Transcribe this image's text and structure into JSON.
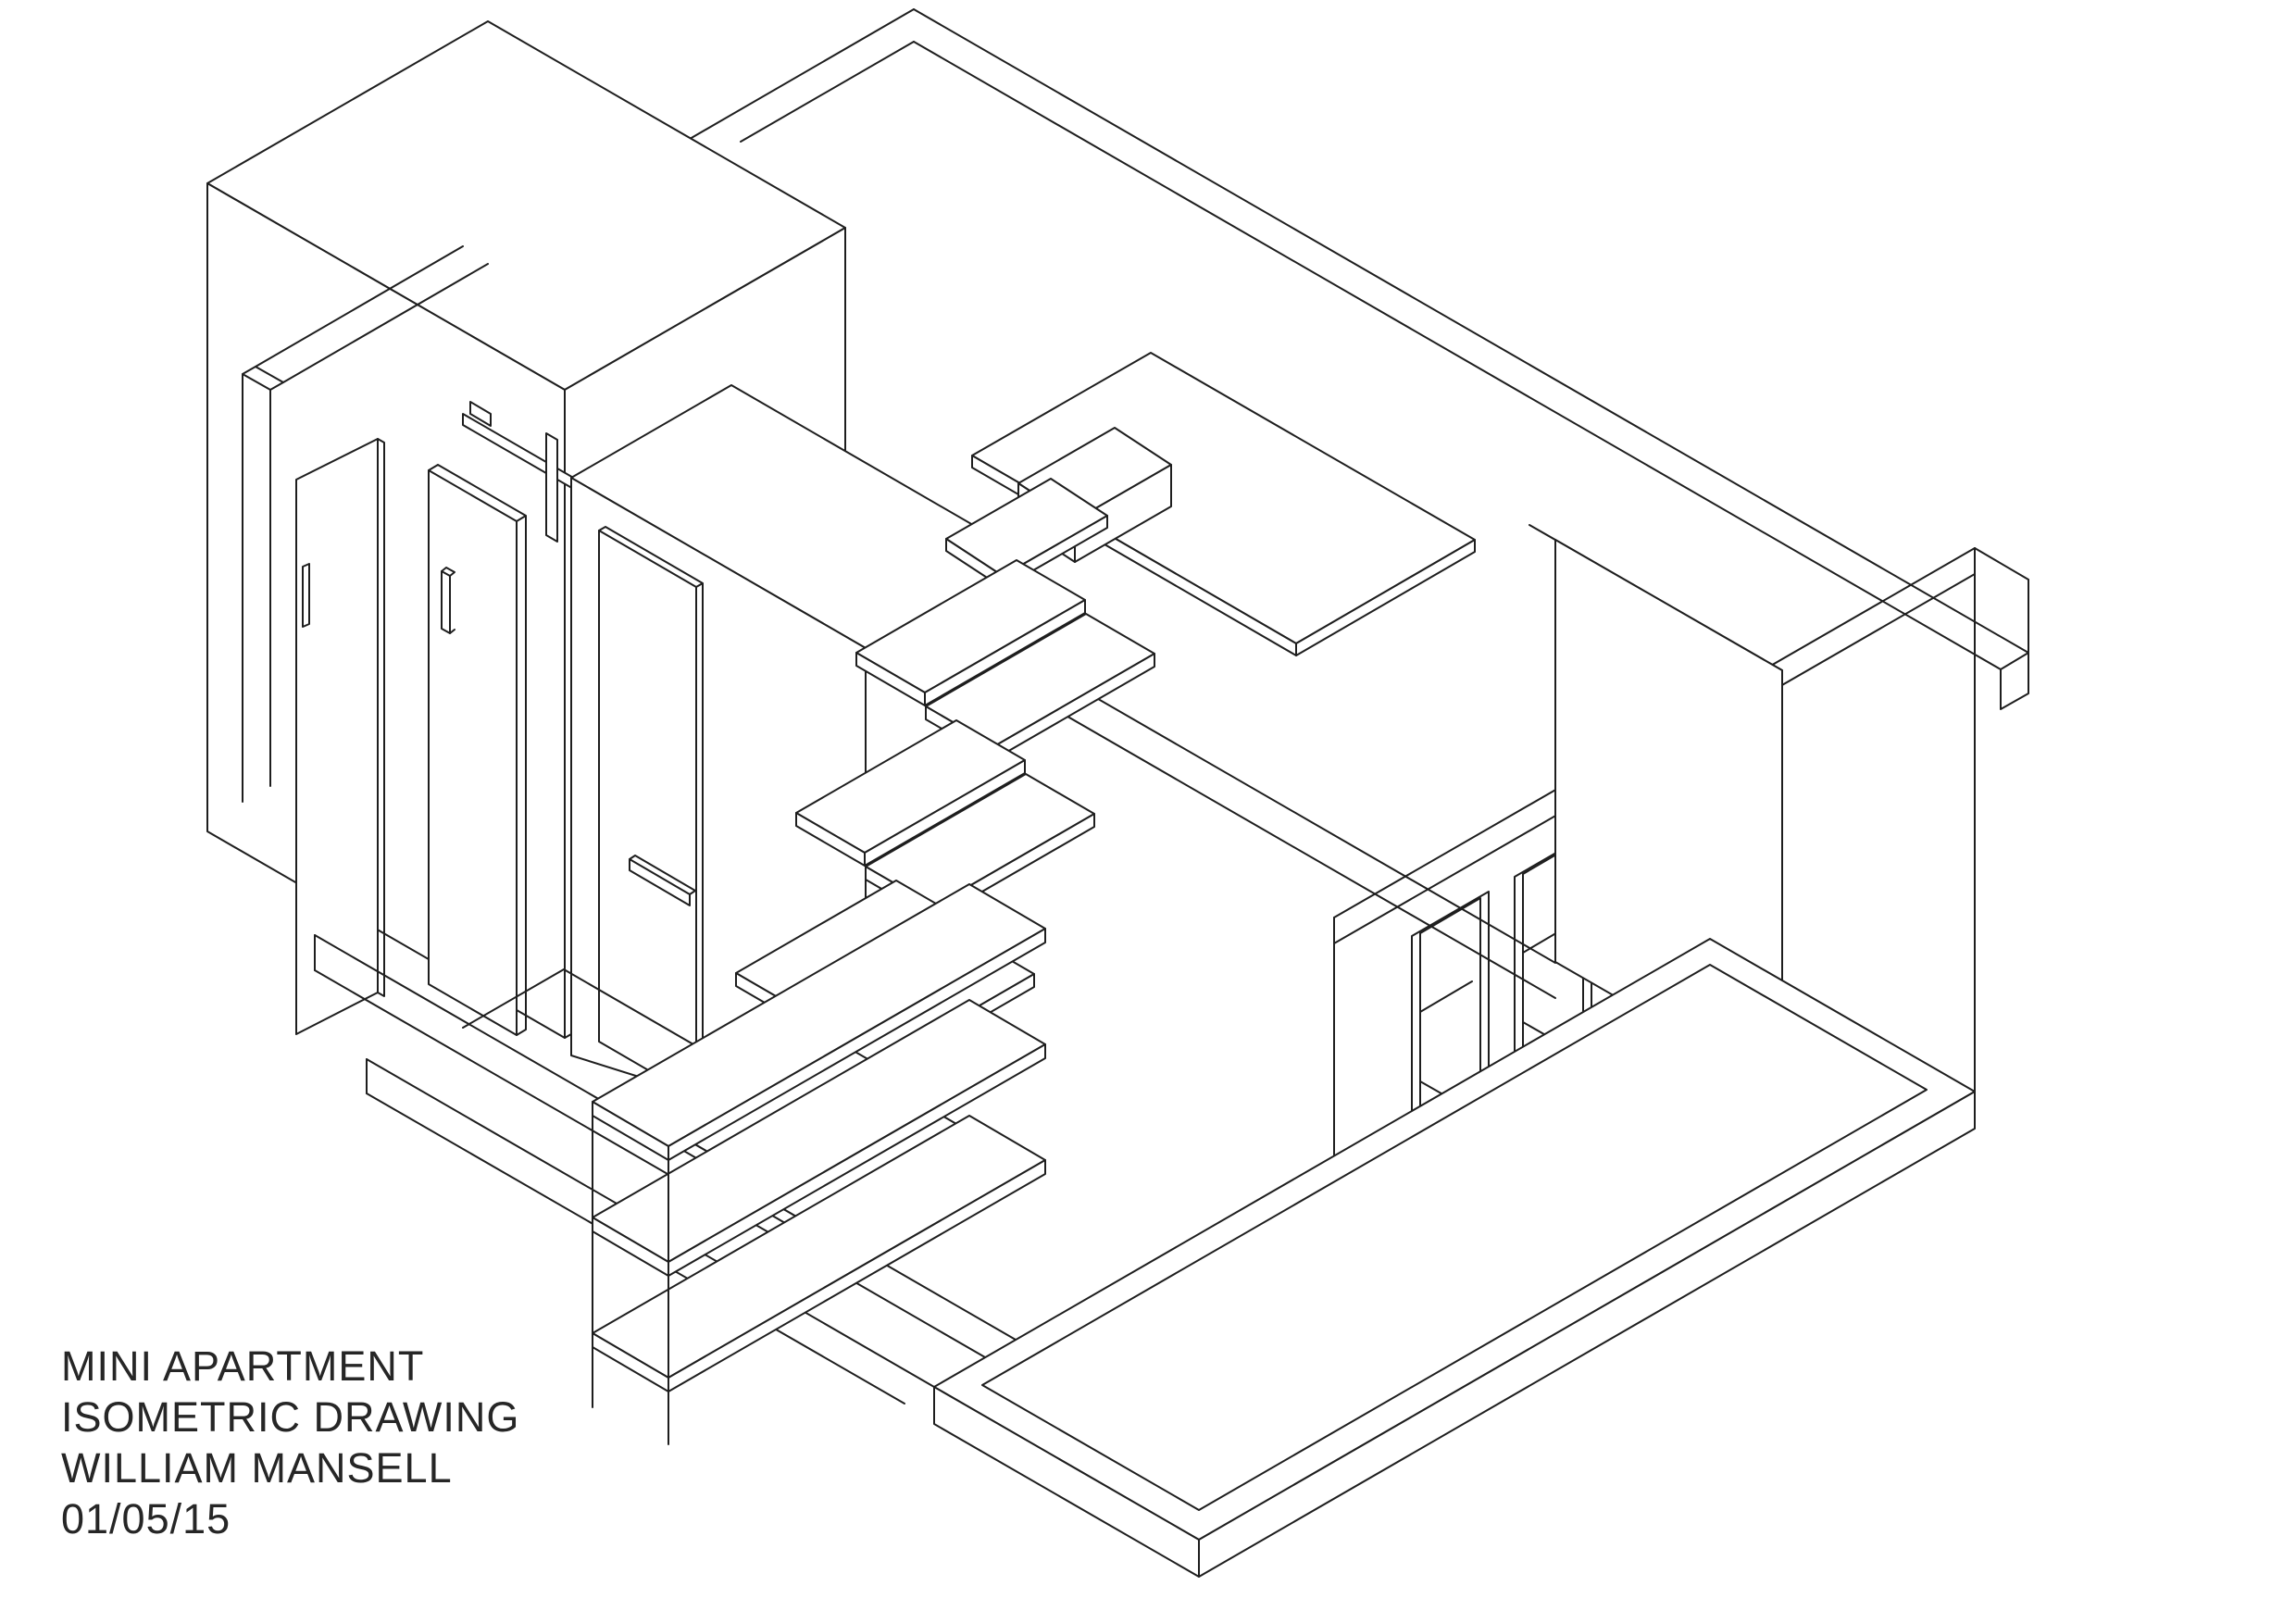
{
  "document": {
    "kind": "isometric architectural line drawing",
    "paper_color": "#ffffff",
    "ink_color": "#1e1e1e"
  },
  "title_block": {
    "line1": "MINI APARTMENT",
    "line2": "ISOMETRIC DRAWING",
    "line3": "WILLIAM MANSELL",
    "line4": "01/05/15"
  },
  "scene": {
    "elements": [
      "back-right wall",
      "back-left wall",
      "entry wall with pocket door",
      "bathroom volume with sliding barn door and rail",
      "closet door",
      "alternating floating stair treads",
      "shelf stack under stairs",
      "loft platform",
      "loft step and stool",
      "cantilevered desk",
      "full-height loft partition",
      "window end wall with three deep windows",
      "floor slab edges",
      "platform bed with mattress"
    ]
  }
}
